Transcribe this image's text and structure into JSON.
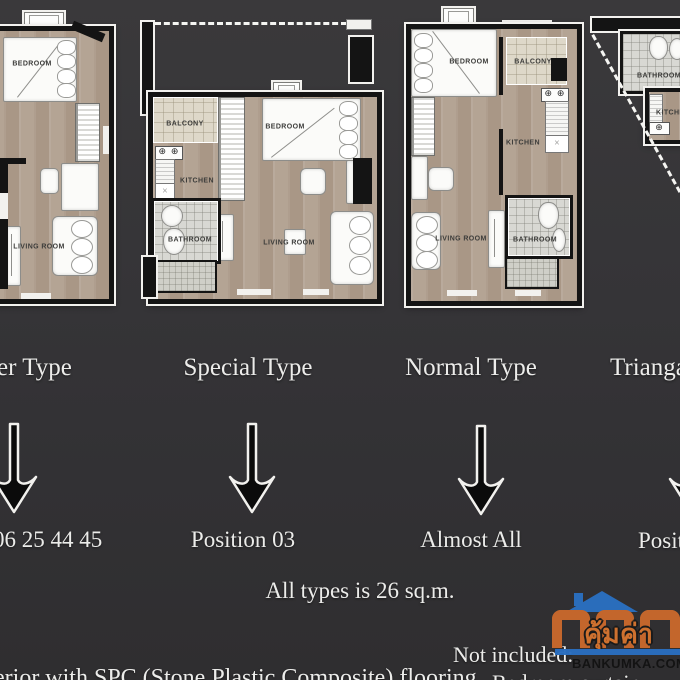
{
  "columns": [
    {
      "title": "er Type",
      "position": "06 25 44 45"
    },
    {
      "title": "Special Type",
      "position": "Position 03"
    },
    {
      "title": "Normal Type",
      "position": "Almost All"
    },
    {
      "title": "Trianga",
      "position": "Positi"
    }
  ],
  "notes": {
    "all_types": "All types is 26 sq.m.",
    "not_included_heading": "Not included:",
    "flooring_line": "erior with SPC (Stone Plastic Composite) flooring",
    "not_included_item": "Bedroom curtain"
  },
  "plans": [
    {
      "name": "corner-type-plan",
      "labels": {
        "bedroom": "BEDROOM",
        "living": "LIVING ROOM"
      }
    },
    {
      "name": "special-type-plan",
      "labels": {
        "balcony": "BALCONY",
        "kitchen": "KITCHEN",
        "bedroom": "BEDROOM",
        "bathroom": "BATHROOM",
        "living": "LIVING ROOM"
      }
    },
    {
      "name": "normal-type-plan",
      "labels": {
        "bedroom": "BEDROOM",
        "balcony": "BALCONY",
        "kitchen": "KITCHEN",
        "living": "LIVING ROOM",
        "bathroom": "BATHROOM"
      }
    },
    {
      "name": "triangle-type-plan",
      "labels": {
        "bathroom": "BATHROOM",
        "kitchen": "KITCHEN"
      }
    }
  ],
  "symbols": {
    "stove": "⊕ ⊕"
  },
  "watermark": {
    "brand_thai": "คุ้มค่า",
    "domain": "BANKUMKA.COM"
  },
  "colors": {
    "background": "#343336",
    "wall": "#141414",
    "wood_floor": "#b1a08f",
    "balcony_tile": "#ded8c9",
    "bathroom_tile": "#d8d8d3",
    "text": "#ececea",
    "logo_orange": "#c8682c",
    "logo_blue": "#2a6fc0"
  }
}
